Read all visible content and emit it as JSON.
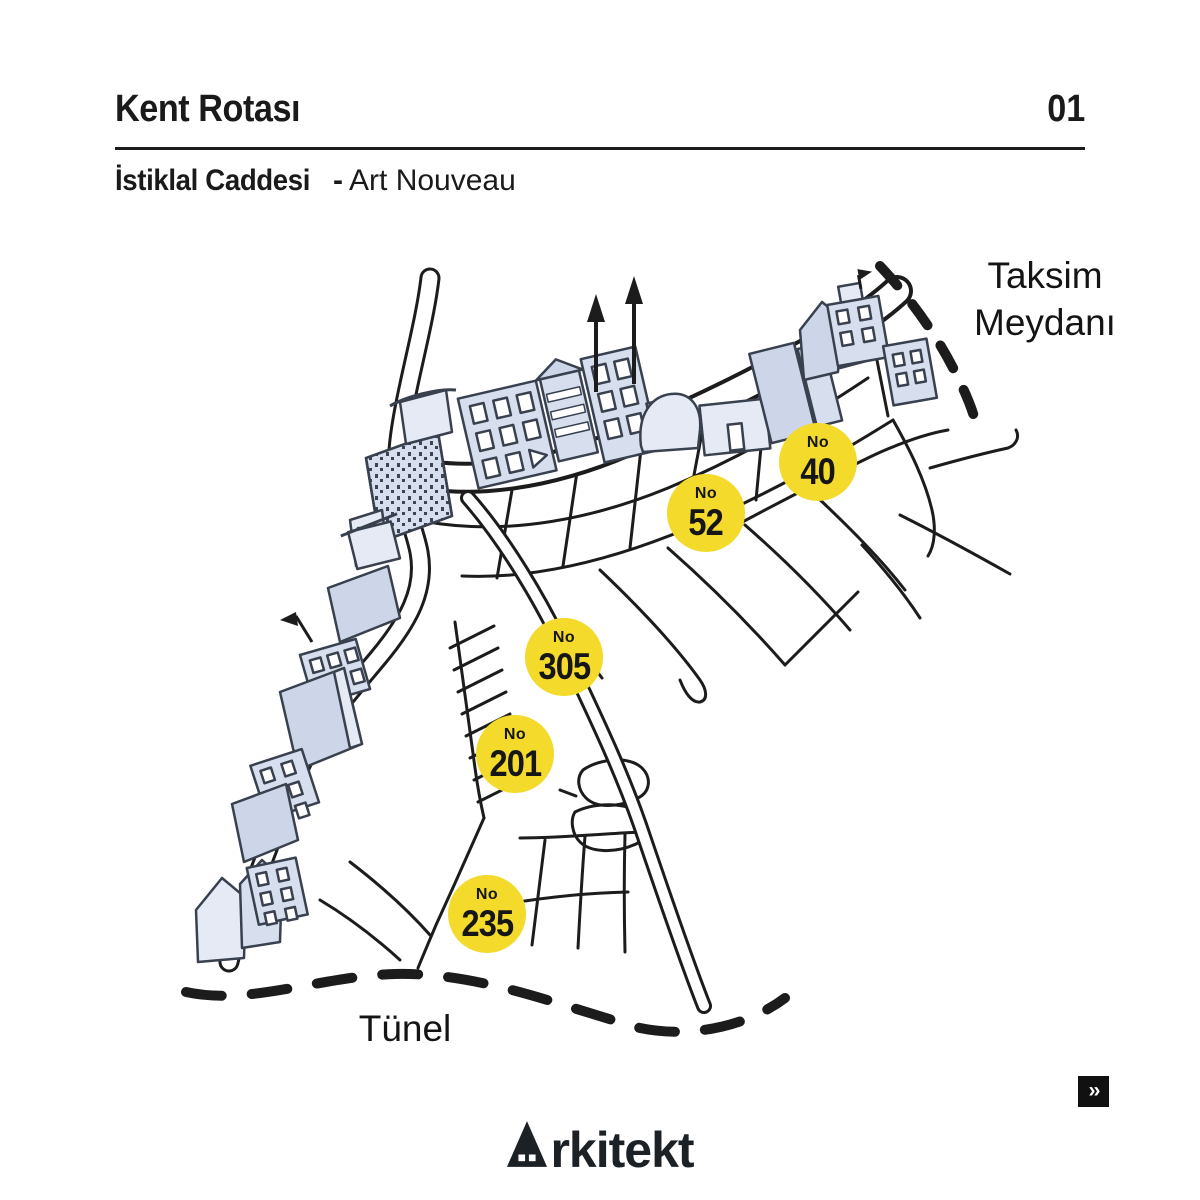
{
  "header": {
    "title": "Kent Rotası",
    "page_number": "01"
  },
  "subtitle": {
    "bold": "İstiklal Caddesi",
    "separator": "-",
    "regular": "Art Nouveau"
  },
  "map": {
    "area_labels": {
      "taksim": {
        "line1": "Taksim",
        "line2": "Meydanı"
      },
      "tunel": {
        "line1": "Tünel"
      }
    },
    "markers": [
      {
        "prefix": "No",
        "number": "40",
        "x": 818,
        "y": 462
      },
      {
        "prefix": "No",
        "number": "52",
        "x": 706,
        "y": 513
      },
      {
        "prefix": "No",
        "number": "305",
        "x": 564,
        "y": 657
      },
      {
        "prefix": "No",
        "number": "201",
        "x": 515,
        "y": 754
      },
      {
        "prefix": "No",
        "number": "235",
        "x": 487,
        "y": 914
      }
    ],
    "colors": {
      "marker_yellow": "#f3da2b",
      "building_fill": "#d7dfee",
      "line": "#1c1c1c"
    }
  },
  "footer": {
    "logo_text": "Arkitekt",
    "next_label": "››"
  }
}
